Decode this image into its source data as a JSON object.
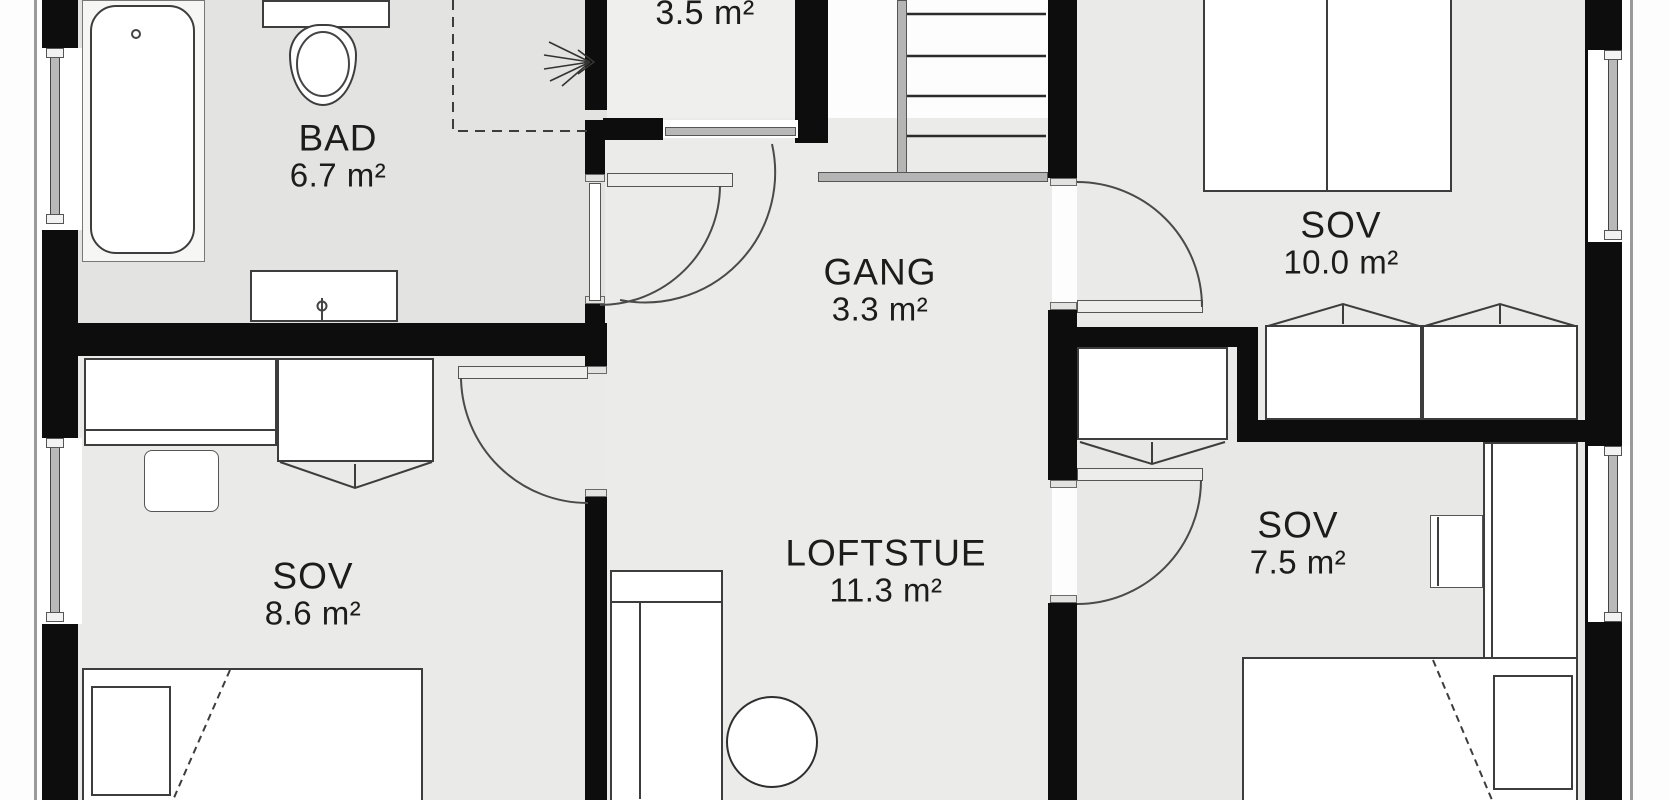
{
  "plan_title": "Loft floor plan",
  "rooms": {
    "bad": {
      "name": "BAD",
      "area": "6.7 m²"
    },
    "storage": {
      "area": "3.5 m²"
    },
    "gang": {
      "name": "GANG",
      "area": "3.3 m²"
    },
    "sov_10": {
      "name": "SOV",
      "area": "10.0 m²"
    },
    "sov_8_6": {
      "name": "SOV",
      "area": "8.6 m²"
    },
    "loftstue": {
      "name": "LOFTSTUE",
      "area": "11.3 m²"
    },
    "sov_7_5": {
      "name": "SOV",
      "area": "7.5 m²"
    }
  },
  "fixtures": [
    "bathtub",
    "toilet",
    "vanity-sink",
    "shower-dashed-zone",
    "ceiling-height-marker",
    "staircase",
    "double-bed",
    "single-bed",
    "single-bed",
    "wardrobe",
    "wardrobe",
    "wardrobe",
    "desk",
    "desk-chair",
    "desk",
    "desk-chair",
    "sofa",
    "round-table",
    "window",
    "window",
    "window",
    "window",
    "door-swing",
    "door-swing",
    "door-swing",
    "door-swing",
    "door-swing"
  ],
  "colors": {
    "wall": "#0d0d0d",
    "floor_main": "#eaeae8",
    "floor_bath": "#e3e3e1",
    "floor_hall": "#ebebe9",
    "floor_storage": "#efefed",
    "furniture_fill": "#ffffff",
    "line": "#3d3d3d",
    "frame_gray": "#b5b5b5",
    "text": "#1c1c1c"
  }
}
